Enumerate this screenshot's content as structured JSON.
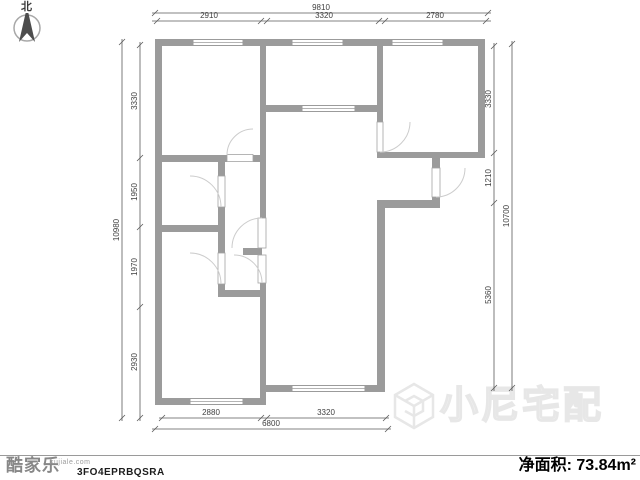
{
  "compass": {
    "north_label": "北"
  },
  "dimensions": {
    "top": {
      "total": "9810",
      "segments": [
        "2910",
        "3320",
        "2780"
      ]
    },
    "left": {
      "total": "10980",
      "segments": [
        "3330",
        "1950",
        "1970",
        "2930"
      ]
    },
    "right": {
      "total": "10700",
      "segments": [
        "3330",
        "1210",
        "5360"
      ]
    },
    "bottom": {
      "total": "6800",
      "segments": [
        "2880",
        "3320"
      ]
    }
  },
  "watermark": {
    "brand": "小尼宅配"
  },
  "footer": {
    "brand": "酷家乐",
    "brand_site": "kujiale.com",
    "plan_code": "3FO4EPRBQSRA",
    "area_label": "净面积:",
    "area_value": "73.84m²"
  },
  "colors": {
    "wall": "#9b9b9b",
    "dimension_line": "#555555",
    "watermark": "#e7e7e7"
  }
}
